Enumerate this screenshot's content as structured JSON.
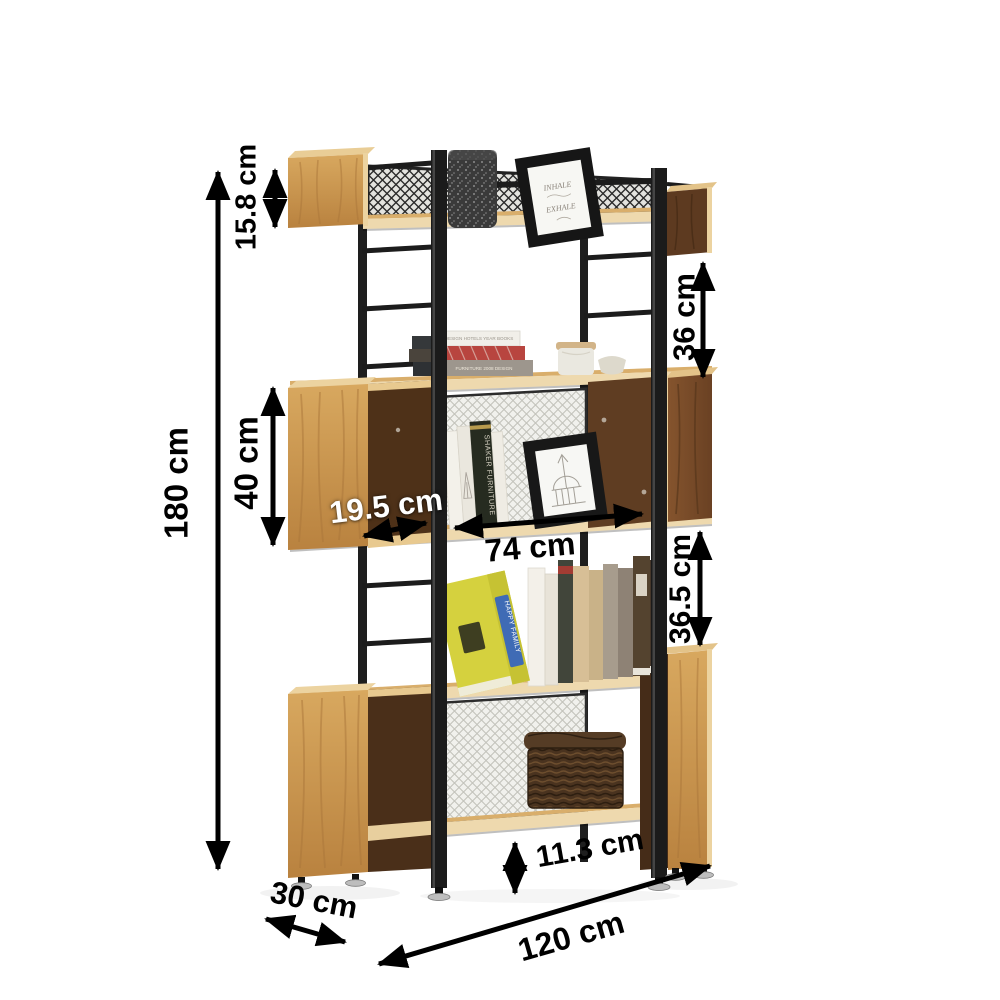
{
  "diagram": {
    "title": "bookshelf-dimension-diagram",
    "dimensions": {
      "total_height": "180 cm",
      "top_box_height": "15.8 cm",
      "upper_gap": "36 cm",
      "middle_box_height": "40 cm",
      "opening_depth": "19.5 cm",
      "inner_width": "74 cm",
      "lower_gap": "36.5 cm",
      "bottom_clearance": "11.3 cm",
      "depth": "30 cm",
      "total_width": "120 cm"
    },
    "decor": {
      "frame_line1": "INHALE",
      "frame_line2": "EXHALE",
      "book_spine": "SHAKER FURNITURE",
      "yellow_book": "HAPPY FAMILY",
      "white_book": "DESIGN HOTELS YEAR BOOKS",
      "gray_book": "FURNITURE 2008 DESIGN"
    },
    "colors": {
      "background": "#ffffff",
      "dimension": "#000000",
      "wood_oak": "#c9954f",
      "wood_edge": "#ecd3a0",
      "wood_walnut": "#6e4527",
      "metal": "#1c1c1c",
      "mesh_light": "#f1f1ed",
      "mesh_dark_line": "#2a2a2a",
      "yellow_book": "#d5d13e",
      "red_book": "#b8453f",
      "basket": "#49321e"
    }
  }
}
